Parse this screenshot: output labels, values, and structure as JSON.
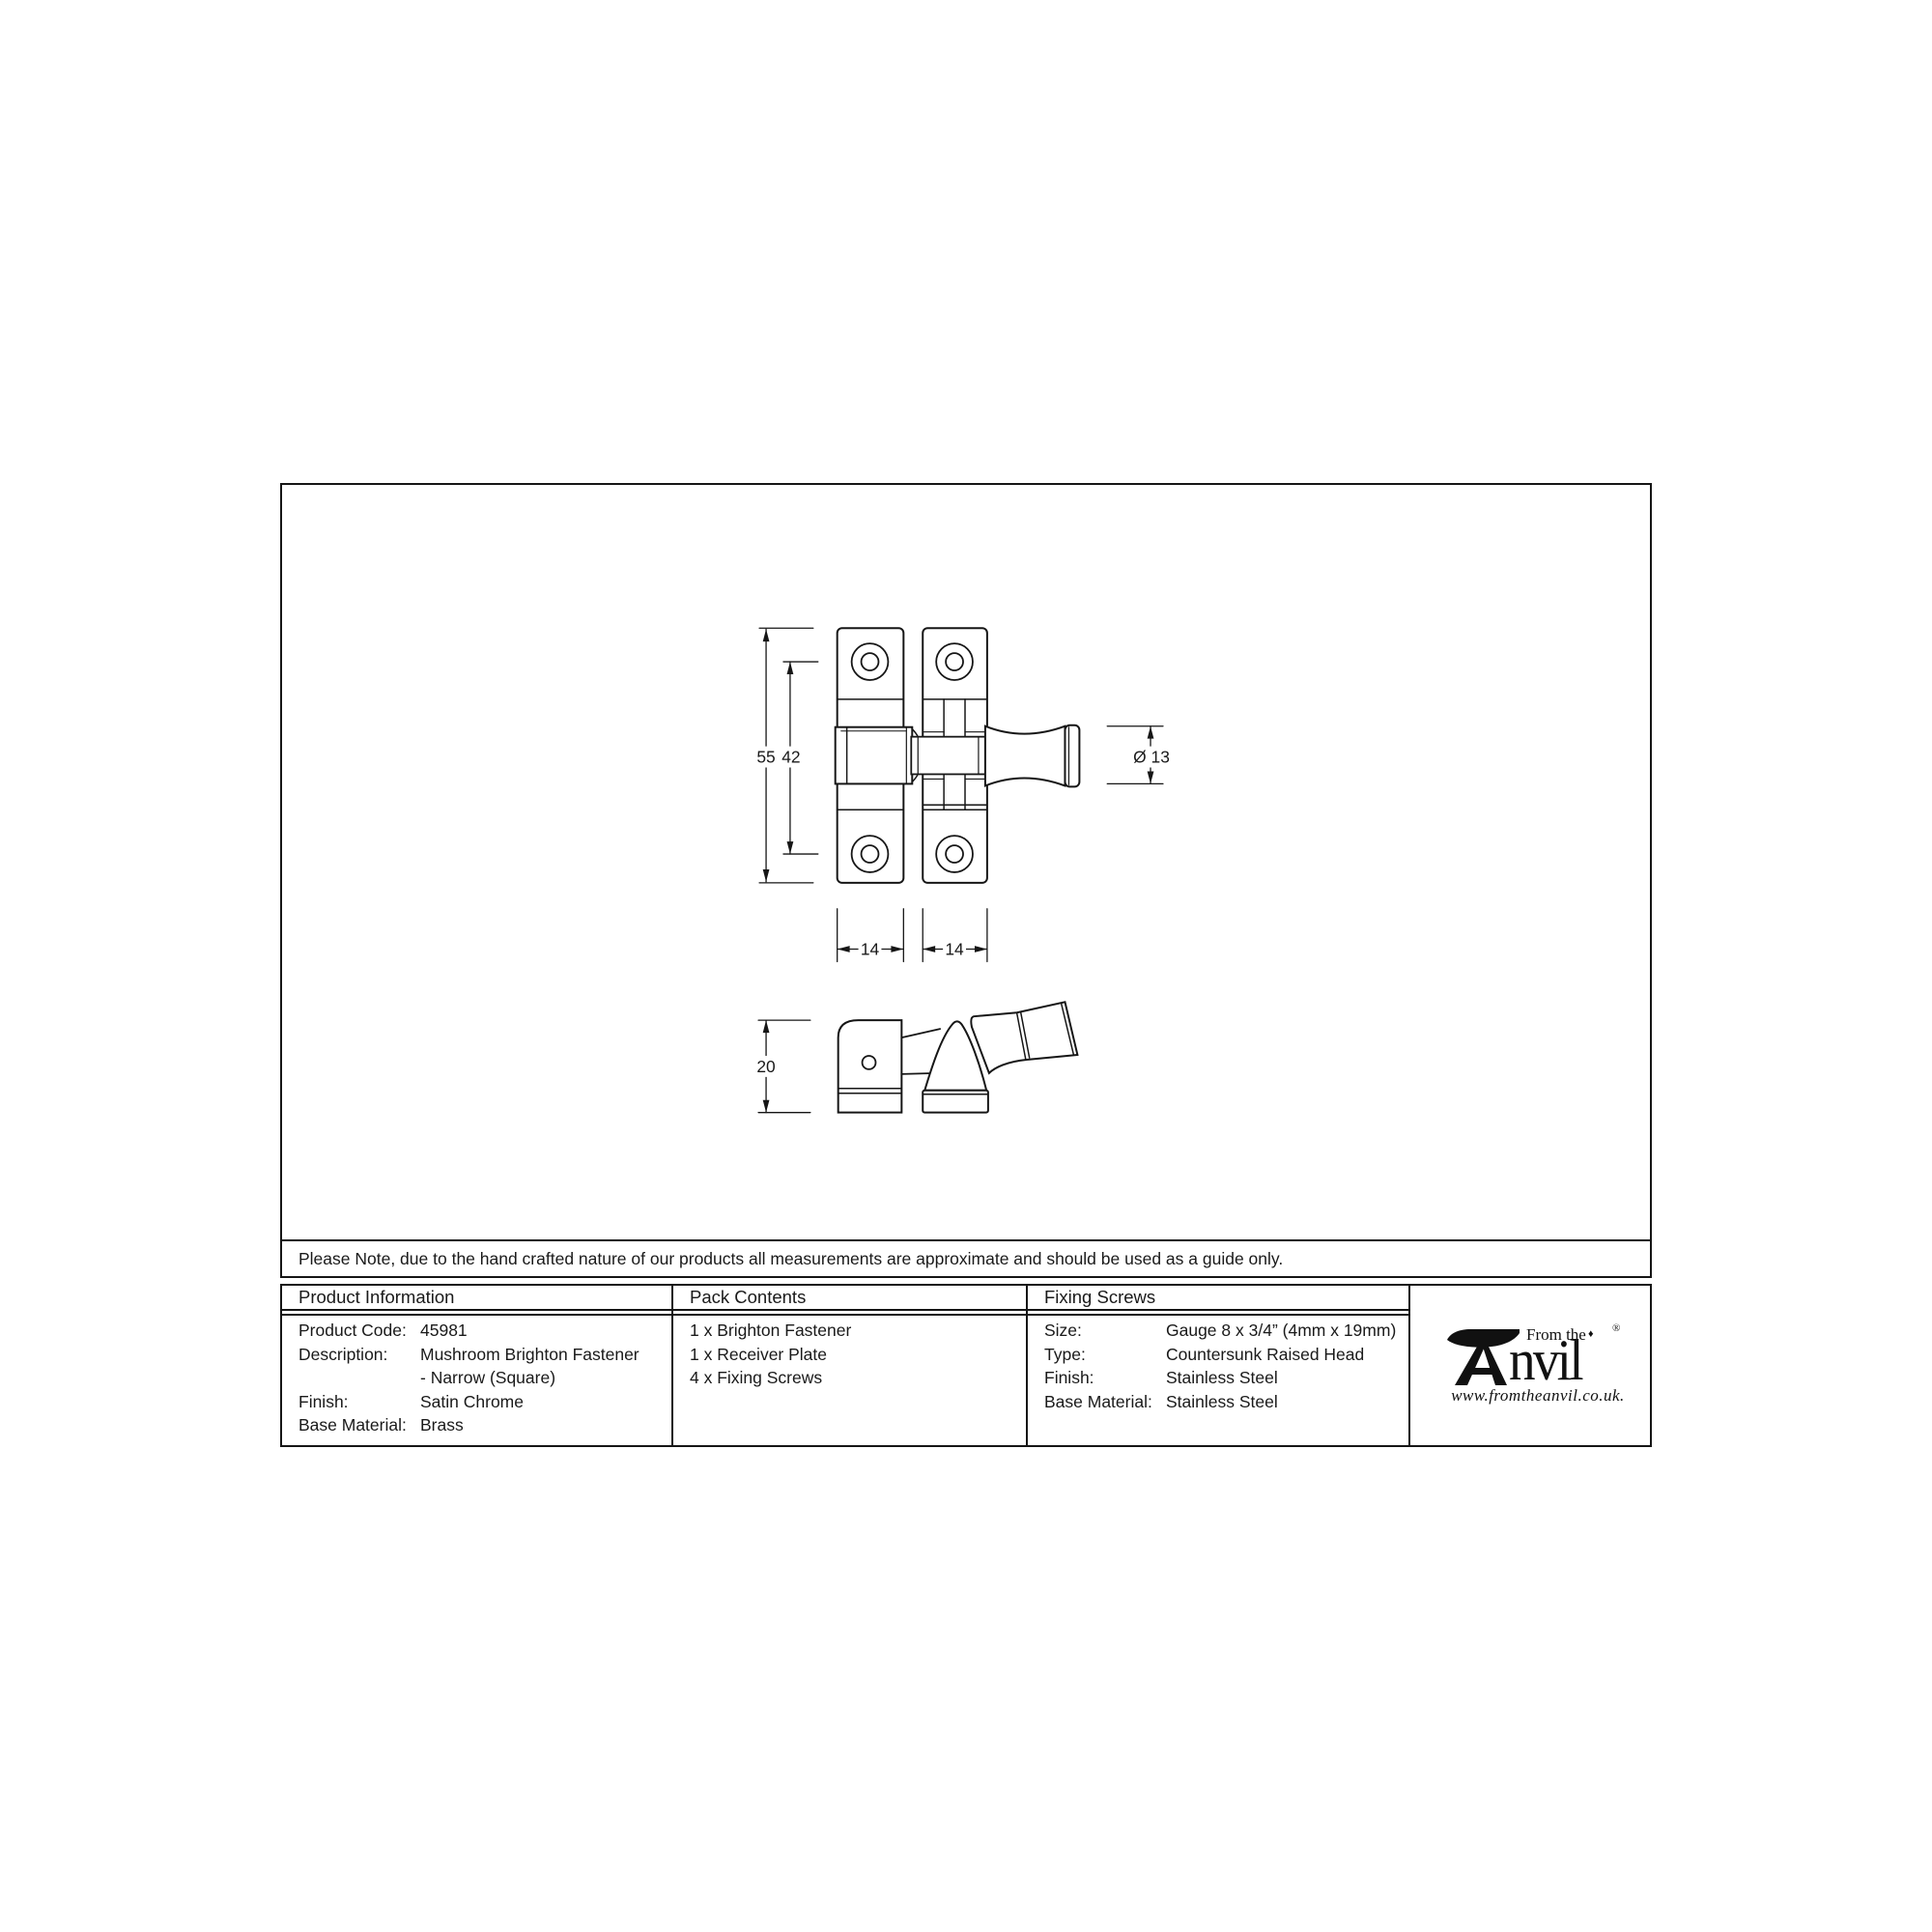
{
  "drawing": {
    "dimensions": {
      "total_height": "55",
      "hole_spacing": "42",
      "knob_diameter": "Ø 13",
      "plate_width_left": "14",
      "plate_width_right": "14",
      "side_depth": "20"
    }
  },
  "note": "Please Note, due to the hand crafted nature of our products all measurements are approximate and should be used as a guide only.",
  "table": {
    "product_information": {
      "header": "Product Information",
      "rows": [
        {
          "label": "Product Code:",
          "value": "45981"
        },
        {
          "label": "Description:",
          "value": "Mushroom Brighton Fastener"
        },
        {
          "label": "",
          "value": "- Narrow (Square)"
        },
        {
          "label": "Finish:",
          "value": "Satin Chrome"
        },
        {
          "label": "Base Material:",
          "value": "Brass"
        }
      ]
    },
    "pack_contents": {
      "header": "Pack Contents",
      "items": [
        "1 x Brighton Fastener",
        "1 x Receiver Plate",
        "4 x Fixing Screws"
      ]
    },
    "fixing_screws": {
      "header": "Fixing Screws",
      "rows": [
        {
          "label": "Size:",
          "value": "Gauge 8 x 3/4” (4mm x 19mm)"
        },
        {
          "label": "Type:",
          "value": "Countersunk Raised Head"
        },
        {
          "label": "Finish:",
          "value": "Stainless Steel"
        },
        {
          "label": "Base Material:",
          "value": "Stainless Steel"
        }
      ]
    }
  },
  "logo": {
    "tagline": "From the",
    "diamond": "♦",
    "brand_suffix": "nvil",
    "registered": "®",
    "website": "www.fromtheanvil.co.uk."
  },
  "colors": {
    "line": "#161616",
    "text": "#1a1a1a",
    "background": "#ffffff"
  }
}
